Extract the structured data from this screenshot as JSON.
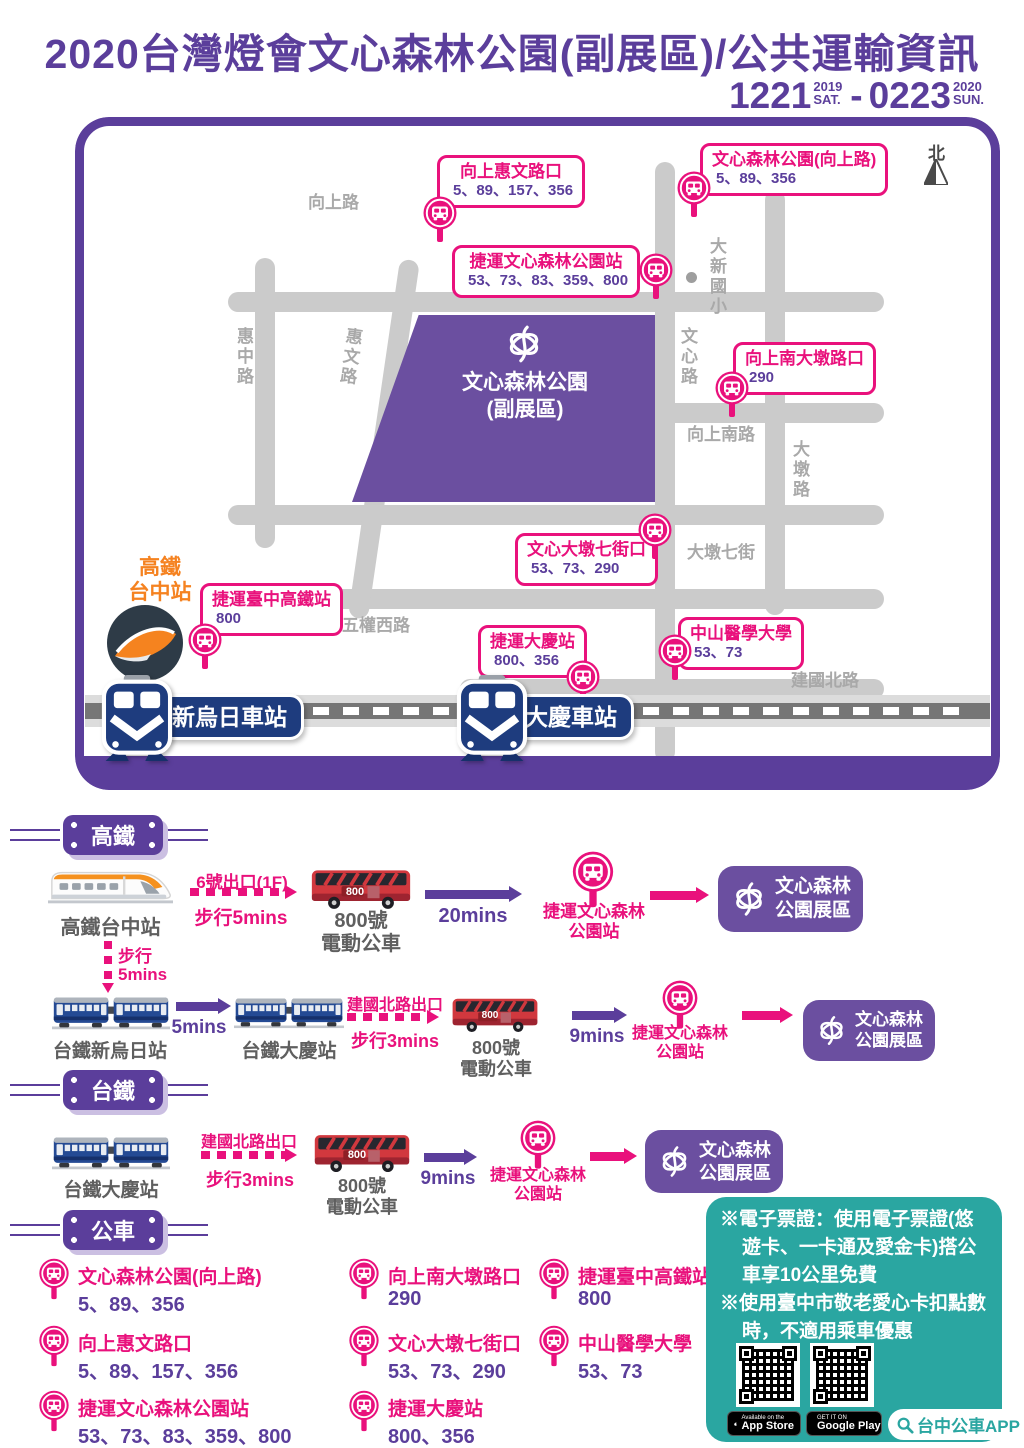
{
  "colors": {
    "purple": "#5B3E9B",
    "pink": "#E9117C",
    "park_purple": "#6B4FA0",
    "teal": "#2AA6A1",
    "orange": "#F58220",
    "navy": "#1E3C7E",
    "bus_red": "#D1383E",
    "road_gray": "#CBCBCB"
  },
  "header": {
    "title": "2020台灣燈會文心森林公園(副展區)/公共運輸資訊",
    "date": {
      "start": "1221",
      "start_year": "2019",
      "start_day": "SAT.",
      "separator": "-",
      "end": "0223",
      "end_year": "2020",
      "end_day": "SUN."
    }
  },
  "map": {
    "north": "北",
    "park": {
      "line1": "文心森林公園",
      "line2": "(副展區)"
    },
    "school": "大新國小",
    "roads": {
      "xiangshang": "向上路",
      "huizhong": "惠中路",
      "huiwen": "惠文路",
      "wenxin": "文心路",
      "xiangshangnan": "向上南路",
      "dadun": "大墩路",
      "dadunqijie": "大墩七街",
      "wuquanxi": "五權西路",
      "jianguobei": "建國北路"
    },
    "hsr_station": {
      "line1": "高鐵",
      "line2": "台中站"
    },
    "tra_stations": {
      "xinwuri": "新烏日車站",
      "daqing": "大慶車站"
    },
    "stops": [
      {
        "name": "向上惠文路口",
        "routes": "5、89、157、356"
      },
      {
        "name": "文心森林公園(向上路)",
        "routes": "5、89、356"
      },
      {
        "name": "捷運文心森林公園站",
        "routes": "53、73、83、359、800"
      },
      {
        "name": "向上南大墩路口",
        "routes": "290"
      },
      {
        "name": "文心大墩七街口",
        "routes": "53、73、290"
      },
      {
        "name": "中山醫學大學",
        "routes": "53、73"
      },
      {
        "name": "捷運臺中高鐵站",
        "routes": "800"
      },
      {
        "name": "捷運大慶站",
        "routes": "800、356"
      }
    ]
  },
  "flows": {
    "hsr_badge": "高鐵",
    "tra_badge": "台鐵",
    "bus_badge": "公車",
    "row1": {
      "origin": "高鐵台中站",
      "exit": "6號出口(1F)",
      "walk": "步行5mins",
      "bus_no": "800",
      "bus_line1": "800號",
      "bus_line2": "電動公車",
      "ride": "20mins",
      "stop_line1": "捷運文心森林",
      "stop_line2": "公園站",
      "dest_line1": "文心森林",
      "dest_line2": "公園展區"
    },
    "transfer": {
      "line1": "步行",
      "line2": "5mins"
    },
    "row2": {
      "origin": "台鐵新烏日站",
      "ride1": "5mins",
      "mid": "台鐵大慶站",
      "exit": "建國北路出口",
      "walk": "步行3mins",
      "bus_no": "800",
      "bus_line1": "800號",
      "bus_line2": "電動公車",
      "ride2": "9mins",
      "stop_line1": "捷運文心森林",
      "stop_line2": "公園站",
      "dest_line1": "文心森林",
      "dest_line2": "公園展區"
    },
    "row3": {
      "origin": "台鐵大慶站",
      "exit": "建國北路出口",
      "walk": "步行3mins",
      "bus_no": "800",
      "bus_line1": "800號",
      "bus_line2": "電動公車",
      "ride": "9mins",
      "stop_line1": "捷運文心森林",
      "stop_line2": "公園站",
      "dest_line1": "文心森林",
      "dest_line2": "公園展區"
    }
  },
  "bus_list": [
    {
      "name": "文心森林公園(向上路)",
      "routes": "5、89、356"
    },
    {
      "name": "向上惠文路口",
      "routes": "5、89、157、356"
    },
    {
      "name": "捷運文心森林公園站",
      "routes": "53、73、83、359、800"
    },
    {
      "name": "向上南大墩路口",
      "routes": "290"
    },
    {
      "name": "文心大墩七街口",
      "routes": "53、73、290"
    },
    {
      "name": "捷運大慶站",
      "routes": "800、356"
    },
    {
      "name": "捷運臺中高鐵站",
      "routes": "800"
    },
    {
      "name": "中山醫學大學",
      "routes": "53、73"
    }
  ],
  "notice": {
    "line1": "※電子票證：使用電子票證(悠遊卡、一卡通及愛金卡)搭公車享10公里免費",
    "line2": "※使用臺中市敬老愛心卡扣點數時，不適用乘車優惠"
  },
  "apps": {
    "appstore_small": "Available on the",
    "appstore": "App Store",
    "google_small": "GET IT ON",
    "google": "Google Play",
    "pill": "台中公車APP"
  }
}
